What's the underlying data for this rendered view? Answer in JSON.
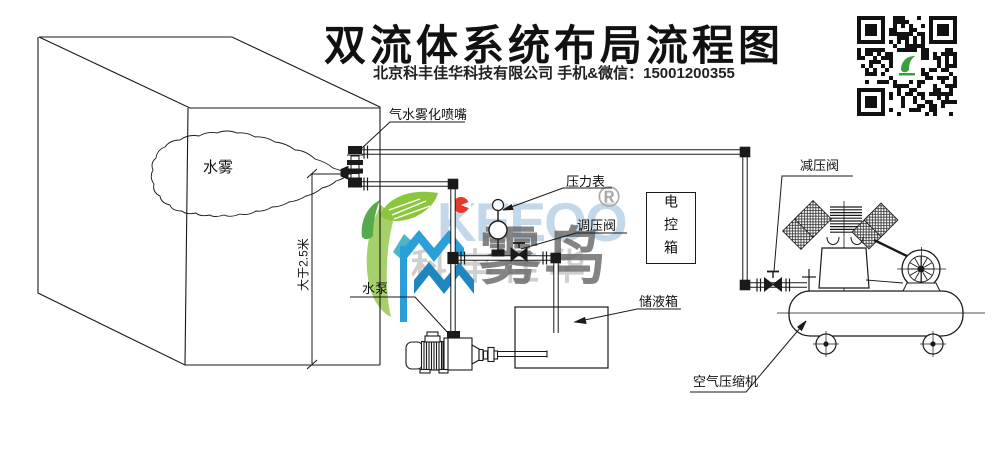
{
  "header": {
    "title": "双流体系统布局流程图",
    "subtitle": "北京科丰佳华科技有限公司 手机&微信：15001200355"
  },
  "labels": {
    "nozzle": "气水雾化喷嘴",
    "water_mist": "水雾",
    "pressure_gauge": "压力表",
    "regulating_valve": "调压阀",
    "electric_control_box": "电控箱",
    "storage_tank": "储液箱",
    "water_pump": "水泵",
    "reducing_valve": "减压阀",
    "air_compressor": "空气压缩机",
    "min_height": "大于2.5米"
  },
  "watermark": {
    "brand_latin": "KEEOO",
    "brand_cn": "雾鸟",
    "company_cn": "科丰佳华",
    "registered": "®",
    "colors": {
      "leaf_green": "#8cc63e",
      "sprout_green": "#57a94d",
      "swoosh_green": "#a5d06a",
      "monogram_blue": "#2b9fd8",
      "monogram_blue_dark": "#1f86c0",
      "monogram_teal": "#4ab6c8",
      "dot_red": "#e83a2c"
    }
  },
  "qr": {
    "center_icon": "green-bird-logo"
  },
  "line_color": "#1a1a1a"
}
